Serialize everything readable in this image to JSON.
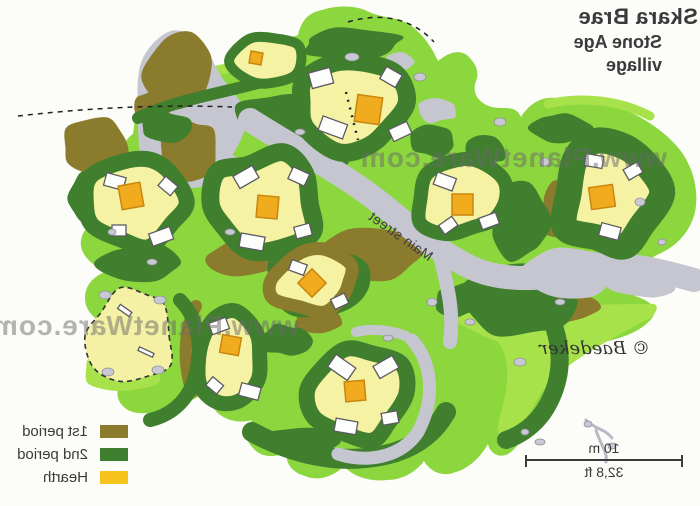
{
  "header": {
    "title": "Skara Brae",
    "subtitle_line1": "Stone Age",
    "subtitle_line2": "village"
  },
  "legend": {
    "items": [
      {
        "label": "1st period",
        "color": "#8b7b2c"
      },
      {
        "label": "2nd period",
        "color": "#3f8030"
      },
      {
        "label": "Hearth",
        "color": "#f6c31c"
      }
    ]
  },
  "scale_bar": {
    "metric": "10 m",
    "imperial": "32,8 ft"
  },
  "map": {
    "street_label": "Main street"
  },
  "copyright_label": "© Baedeker",
  "watermark_text": "www.PlanetWare.com",
  "colors": {
    "light_green": "#8cd63e",
    "lime_accent": "#a8e24a",
    "dark_green_2nd_period": "#3f7f2d",
    "olive_1st_period": "#8b7b2c",
    "house_floor": "#f6f2a3",
    "hearth": "#f0ab1e",
    "passage_gray": "#c6c6d0"
  }
}
